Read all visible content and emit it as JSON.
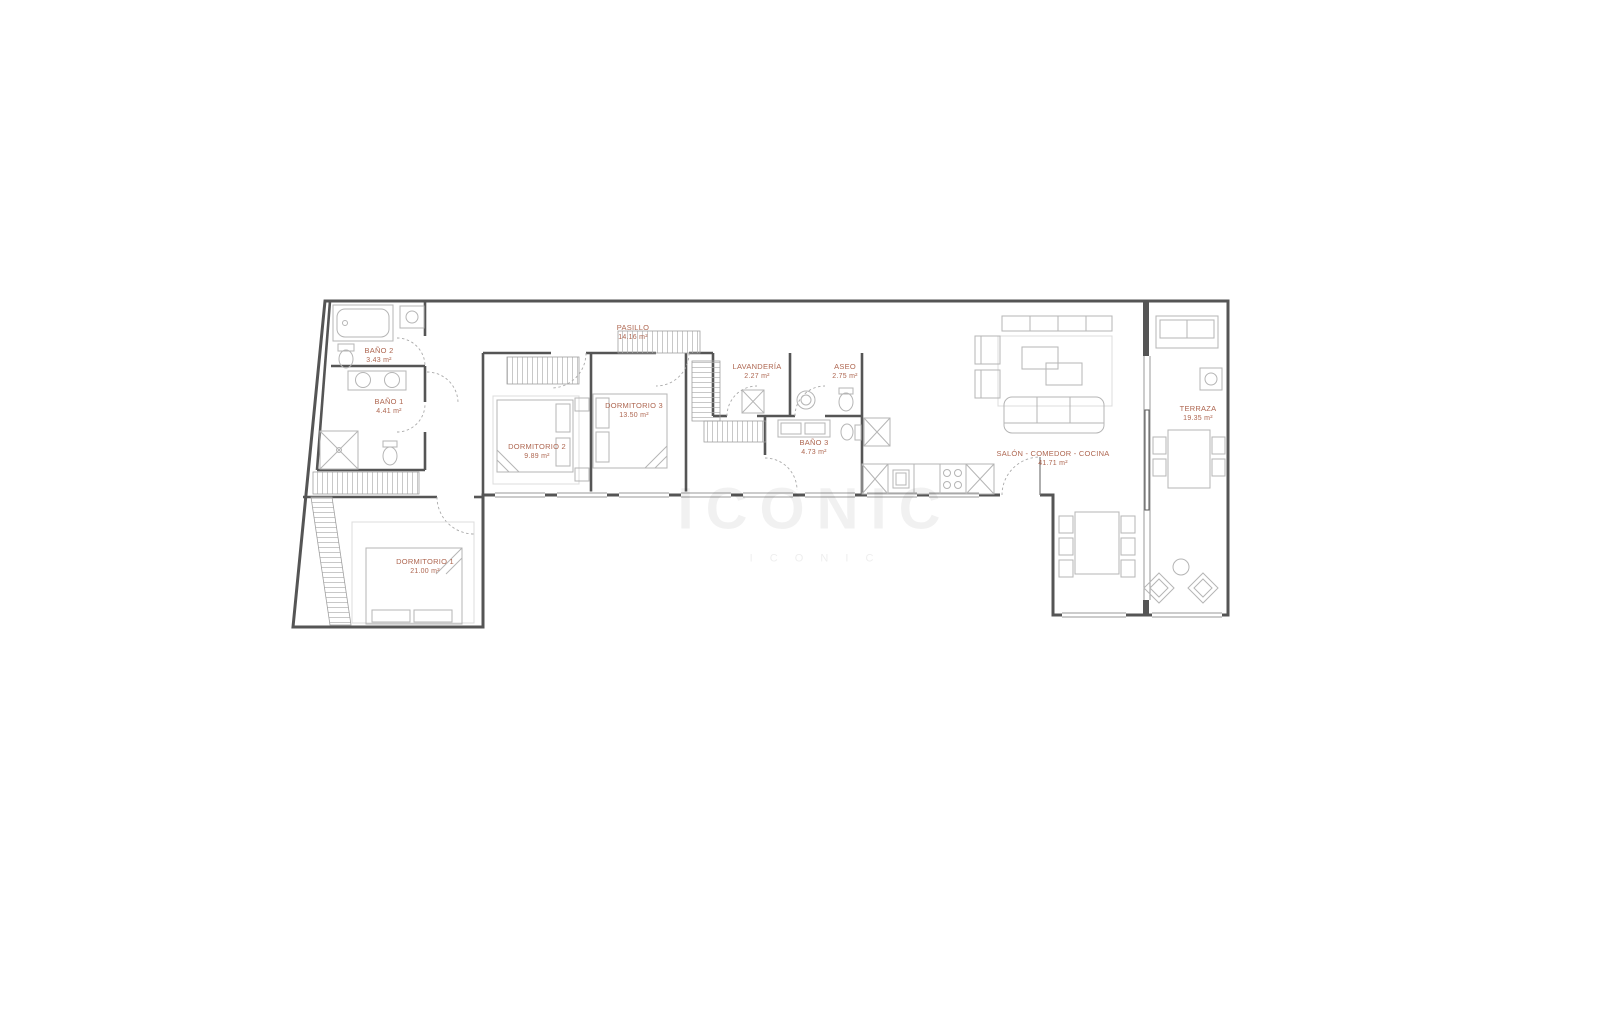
{
  "plan": {
    "type": "apartment-floor-plan",
    "area_unit": "m²",
    "label_color": "#ae6650",
    "wall_color": "#555555",
    "rooms": {
      "bano2": {
        "name": "BAÑO 2",
        "area": "3.43 m²"
      },
      "bano1": {
        "name": "BAÑO 1",
        "area": "4.41 m²"
      },
      "pasillo": {
        "name": "PASILLO",
        "area": "14.16 m²"
      },
      "dormitorio2": {
        "name": "DORMITORIO 2",
        "area": "9.89 m²"
      },
      "dormitorio3": {
        "name": "DORMITORIO 3",
        "area": "13.50 m²"
      },
      "lavanderia": {
        "name": "LAVANDERÍA",
        "area": "2.27 m²"
      },
      "aseo": {
        "name": "ASEO",
        "area": "2.75 m²"
      },
      "bano3": {
        "name": "BAÑO 3",
        "area": "4.73 m²"
      },
      "dormitorio1": {
        "name": "DORMITORIO 1",
        "area": "21.00 m²"
      },
      "salon": {
        "name": "SALÓN - COMEDOR - COCINA",
        "area": "41.71 m²"
      },
      "terraza": {
        "name": "TERRAZA",
        "area": "19.35 m²"
      }
    },
    "watermark": {
      "line1": "ICONIC",
      "line2": "I C O N I C"
    }
  }
}
